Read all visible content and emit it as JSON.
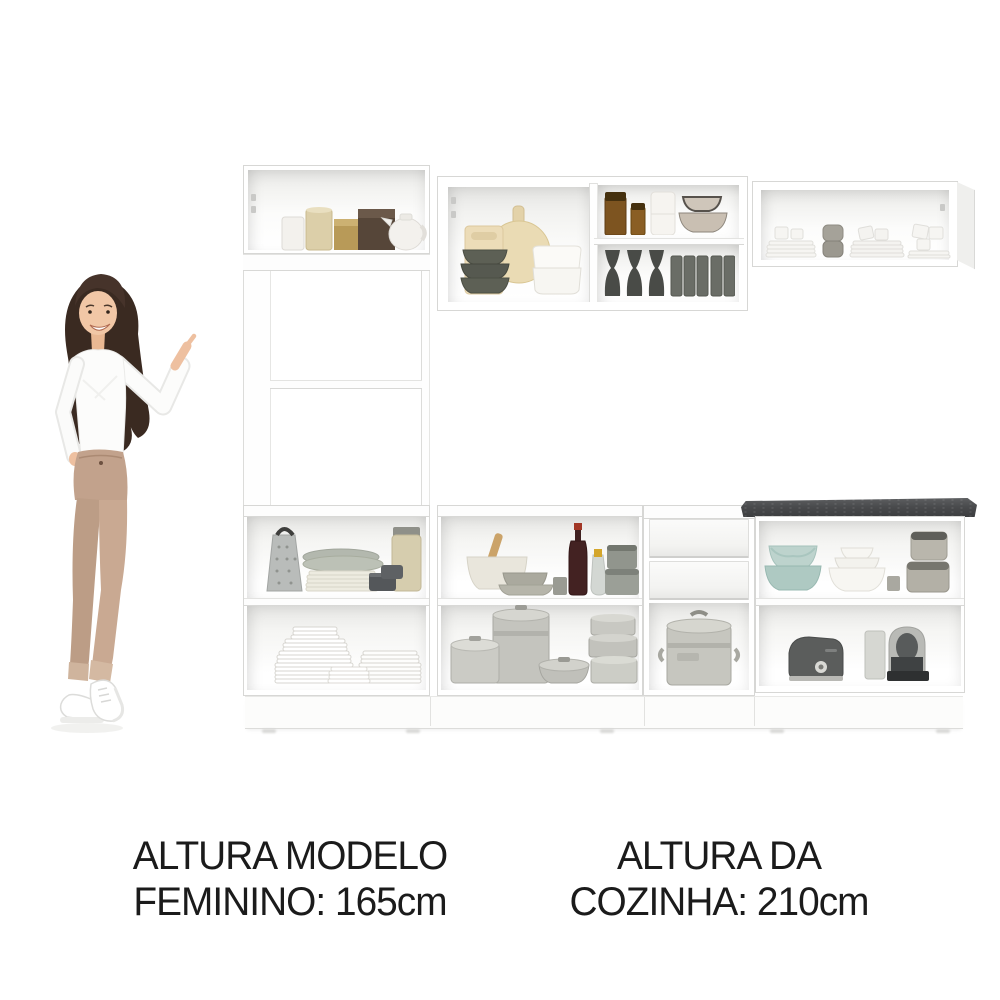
{
  "captions": {
    "model_height": {
      "line1": "ALTURA MODELO",
      "line2": "FEMININO: 165cm"
    },
    "kitchen_height": {
      "line1": "ALTURA DA",
      "line2": "COZINHA: 210cm"
    }
  },
  "palette": {
    "background": "#ffffff",
    "cabinet_white": "#ffffff",
    "cabinet_edge": "#d7d7d5",
    "interior_shadow": "#e3e3e1",
    "countertop": "#4a4b4d",
    "text": "#1b1b1b"
  },
  "model": {
    "description": "female model pointing at the kitchen set",
    "hair_color": "#3a2a21",
    "skin_color": "#efc3a2",
    "top_color": "#fbfbfb",
    "pants_color": "#c2a28c",
    "shoes_color": "#ffffff"
  },
  "kitchen": {
    "compartments": {
      "tall_cabinet_top": [
        "white-mug",
        "gold-canister",
        "gold-tin",
        "brown-box",
        "white-teapot"
      ],
      "wall_cabinet_left_section": [
        "rectangular-cutting-board",
        "round-cutting-board",
        "olive-bowl-stack",
        "white-bowl-stack"
      ],
      "wall_cabinet_right_top_shelf": [
        "amber-jar",
        "amber-jar-small",
        "white-canister-stack",
        "beige-bowl-stack"
      ],
      "wall_cabinet_right_bottom_shelf": [
        "dark-goblets",
        "gray-tumblers"
      ],
      "wall_cabinet_far_right": [
        "white-plate-stacks",
        "white-cups",
        "gray-canister-stack"
      ],
      "base_left_top_shelf": [
        "cheese-grater",
        "platter-and-plate-stack",
        "glass-jar",
        "dark-mini-pots"
      ],
      "base_left_bottom_shelf": [
        "tall-plate-stack",
        "plate-stack",
        "saucer-stack"
      ],
      "base_middle_top_shelf": [
        "mixing-bowl-with-spoon",
        "gray-bowl-stack",
        "wine-bottle",
        "oil-bottle",
        "gray-canisters"
      ],
      "base_middle_bottom_shelf": [
        "saucepan",
        "stockpot",
        "casserole",
        "pot-stack"
      ],
      "drawer_unit": [
        "drawer",
        "drawer",
        "aluminum-canister-pot"
      ],
      "base_right_top_shelf": [
        "teal-bowl-stack",
        "white-nested-bowls",
        "gray-canister-stack"
      ],
      "base_right_bottom_shelf": [
        "toaster",
        "espresso-machine"
      ]
    }
  }
}
